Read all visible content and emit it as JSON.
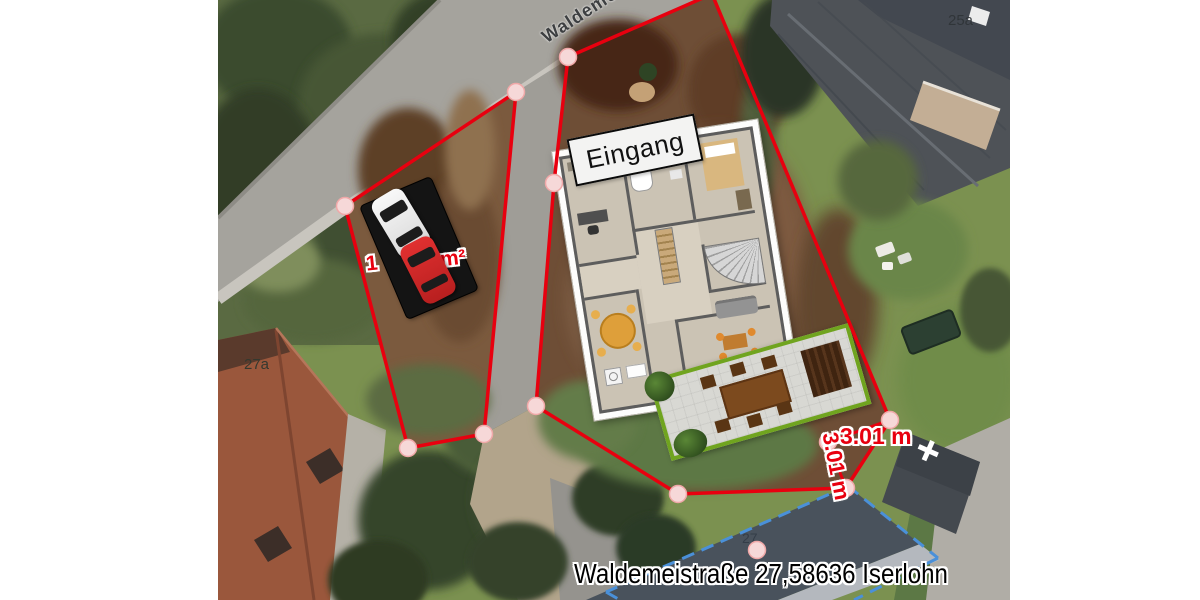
{
  "map": {
    "street_name": "Waldemeist",
    "entrance": "Eingang",
    "address": "Waldemeistraße 27,58636 Iserlohn",
    "measurements": {
      "horizontal": "3.01 m",
      "vertical": "3.01 m"
    },
    "parking_area_label": {
      "left_fragment": "1",
      "right_fragment": "m²"
    },
    "house_numbers": {
      "n25a": "25a",
      "n27a": "27a",
      "n27": "27"
    },
    "colors": {
      "boundary_red": "#e8000f",
      "vertex_fill": "#f6d8d8",
      "building_outline_blue": "#4a90d9",
      "terrace_green": "#70a41f",
      "measurement_text_red": "#e8000f",
      "entrance_box_bg": "#f3f3f2"
    }
  }
}
